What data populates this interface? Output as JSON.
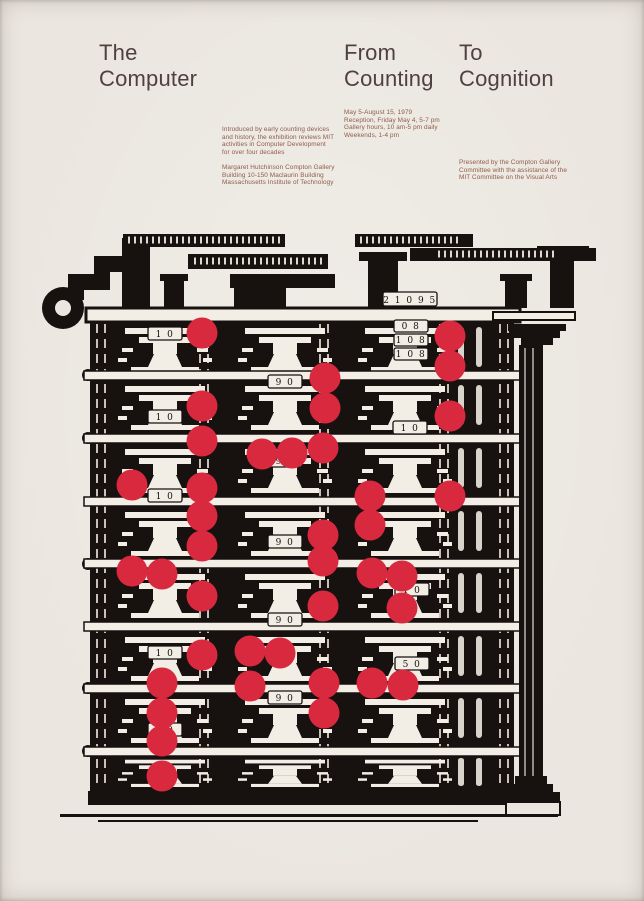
{
  "title": {
    "col1_line1": "The",
    "col1_line2": "Computer",
    "col2_line1": "From",
    "col2_line2": "Counting",
    "col3_line1": "To",
    "col3_line2": "Cognition"
  },
  "info": {
    "dates": [
      "May 5-August 15, 1979",
      "Reception, Friday May 4, 5-7 pm",
      "Gallery hours, 10 am-5 pm daily",
      "Weekends, 1-4 pm"
    ],
    "intro": [
      "Introduced by early counting devices",
      "and history, the exhibition reviews MIT",
      "activities in Computer Development",
      "for over four decades"
    ],
    "location": [
      "Margaret Hutchinson Compton Gallery",
      "Building 10-150 Maclaurin Building",
      "Massachusetts Institute of Technology"
    ],
    "credits": [
      "Presented by the Compton Gallery",
      "Committee with the assistance of the",
      "MIT Committee on the Visual Arts"
    ]
  },
  "machine": {
    "plates": [
      "1 0",
      "2 1 0 9 5",
      "0 8",
      "1 0 8",
      "1 0 8",
      "9 0",
      "1 0",
      "1 0",
      "9 0",
      "1 0",
      "9 0",
      "1 0",
      "9 0",
      "1 0",
      "5 0",
      "9 0",
      "1 0"
    ],
    "dot_radius": 15.5,
    "dots": [
      [
        164,
        109
      ],
      [
        412,
        112
      ],
      [
        412,
        142
      ],
      [
        287,
        154
      ],
      [
        164,
        182
      ],
      [
        287,
        184
      ],
      [
        412,
        192
      ],
      [
        164,
        217
      ],
      [
        285,
        224
      ],
      [
        224,
        230
      ],
      [
        254,
        229
      ],
      [
        94,
        261
      ],
      [
        164,
        264
      ],
      [
        332,
        272
      ],
      [
        412,
        272
      ],
      [
        164,
        292
      ],
      [
        332,
        301
      ],
      [
        285,
        311
      ],
      [
        164,
        322
      ],
      [
        285,
        337
      ],
      [
        94,
        347
      ],
      [
        124,
        350
      ],
      [
        334,
        349
      ],
      [
        364,
        352
      ],
      [
        164,
        372
      ],
      [
        285,
        382
      ],
      [
        364,
        384
      ],
      [
        212,
        427
      ],
      [
        242,
        429
      ],
      [
        164,
        431
      ],
      [
        124,
        459
      ],
      [
        212,
        462
      ],
      [
        286,
        459
      ],
      [
        334,
        459
      ],
      [
        365,
        461
      ],
      [
        286,
        489
      ],
      [
        124,
        489
      ],
      [
        124,
        517
      ],
      [
        124,
        552
      ]
    ]
  },
  "colors": {
    "bg": "#ebe7e0",
    "ink": "#171110",
    "dot": "#d8293f",
    "title": "#514040",
    "small": "#8f5c49",
    "paper": "#f3eee5"
  }
}
